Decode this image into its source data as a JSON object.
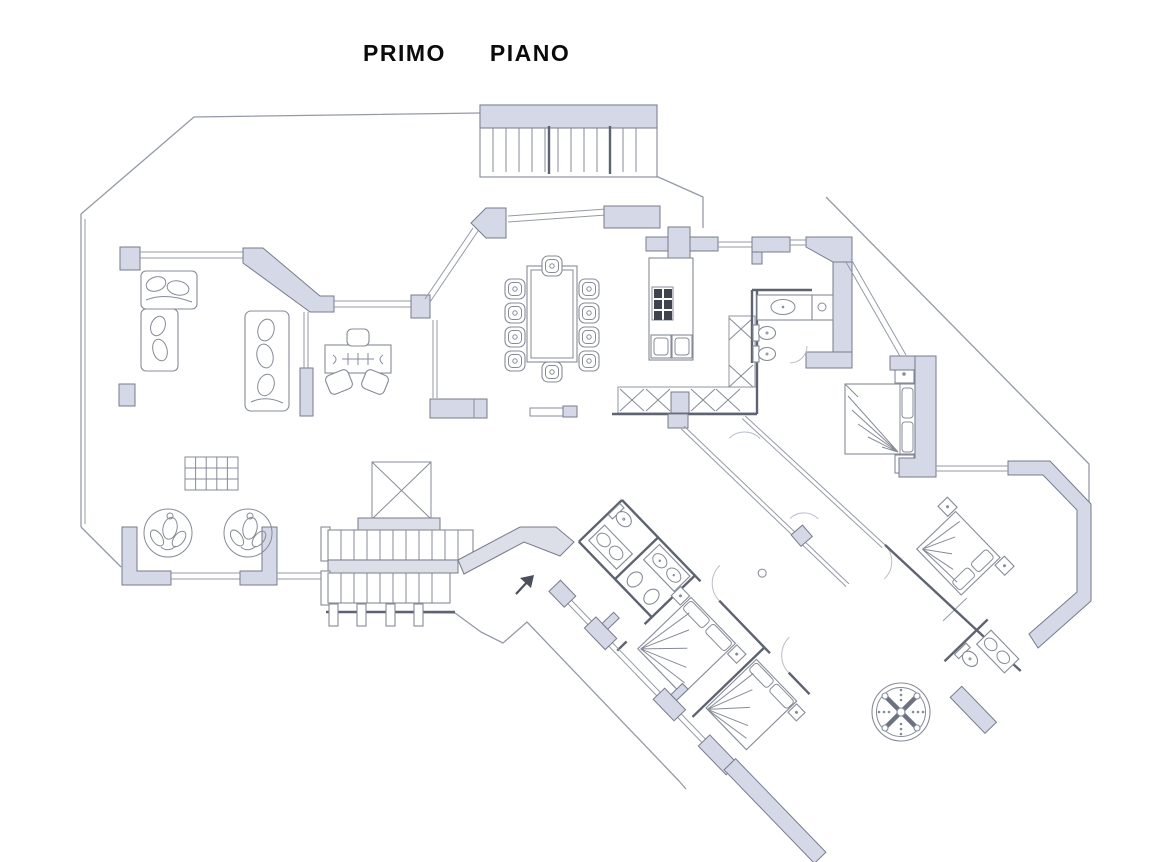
{
  "title": {
    "word1": "PRIMO",
    "word2": "PIANO"
  },
  "plan": {
    "floor_label": "PRIMO PIANO",
    "entrance_arrow_icon": "arrow-up-right",
    "features": {
      "external_staircase": true,
      "internal_staircase_flights": 2,
      "elevator_shaft_marked_x": true,
      "dining_seats": 10,
      "round_armchairs": 2,
      "bedrooms": 4,
      "bathrooms": 4,
      "jacuzzi": true,
      "kitchen_burners": 6,
      "kitchen_sinks": 2
    }
  },
  "colors": {
    "background": "#ffffff",
    "title": "#0b0b0b",
    "wall": "#d5d8e6",
    "wall_stroke": "#767c8a",
    "thin_line": "#949aa6",
    "dark_line": "#5d6370",
    "furniture": "#858b97",
    "stair_fill": "#dcdee8",
    "arc": "#b9bec9",
    "burner": "#3f434d"
  }
}
